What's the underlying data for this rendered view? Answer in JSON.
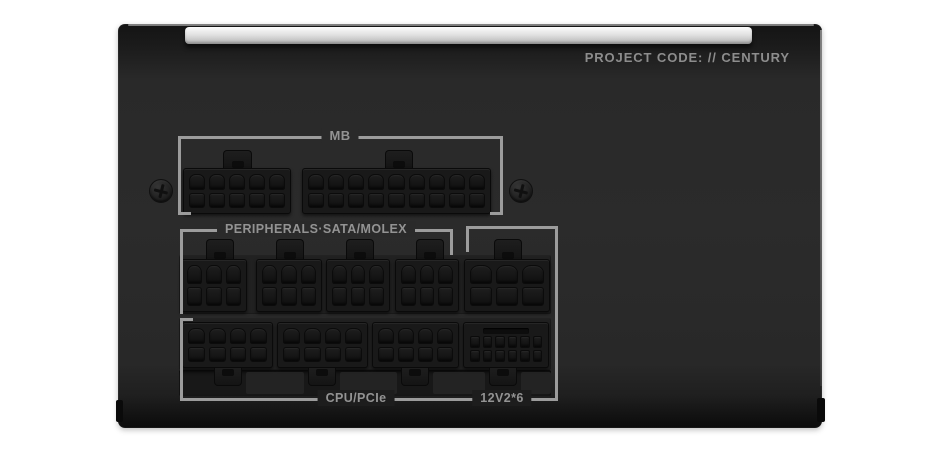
{
  "panel": {
    "project_code": "PROJECT CODE: // CENTURY"
  },
  "groups": {
    "mb": {
      "label": "MB"
    },
    "peripherals": {
      "label": "PERIPHERALS·SATA/MOLEX"
    },
    "cpu_pcie": {
      "label": "CPU/PCIe"
    },
    "v12": {
      "label": "12V2*6"
    }
  },
  "connectors": {
    "mb": [
      {
        "type": "10-pin",
        "rows": 2,
        "cols": 5
      },
      {
        "type": "18-pin",
        "rows": 2,
        "cols": 9
      }
    ],
    "peripherals": [
      {
        "type": "6-pin",
        "rows": 2,
        "cols": 3
      },
      {
        "type": "6-pin",
        "rows": 2,
        "cols": 3
      },
      {
        "type": "6-pin",
        "rows": 2,
        "cols": 3
      },
      {
        "type": "6-pin",
        "rows": 2,
        "cols": 3
      },
      {
        "type": "6-pin",
        "rows": 2,
        "cols": 3
      }
    ],
    "cpu_pcie": [
      {
        "type": "8-pin",
        "rows": 2,
        "cols": 4
      },
      {
        "type": "8-pin",
        "rows": 2,
        "cols": 4
      },
      {
        "type": "8-pin",
        "rows": 2,
        "cols": 4
      }
    ],
    "v12": [
      {
        "type": "16-pin 12V-2x6",
        "rows": 2,
        "cols": 6,
        "sense_slot": true
      }
    ]
  },
  "colors": {
    "page_bg": "#ffffff",
    "case_body": "#2a2a2a",
    "top_bar_silver": "#d9d9d9",
    "label_text": "#939393",
    "bracket_line": "#9c9c9c"
  }
}
